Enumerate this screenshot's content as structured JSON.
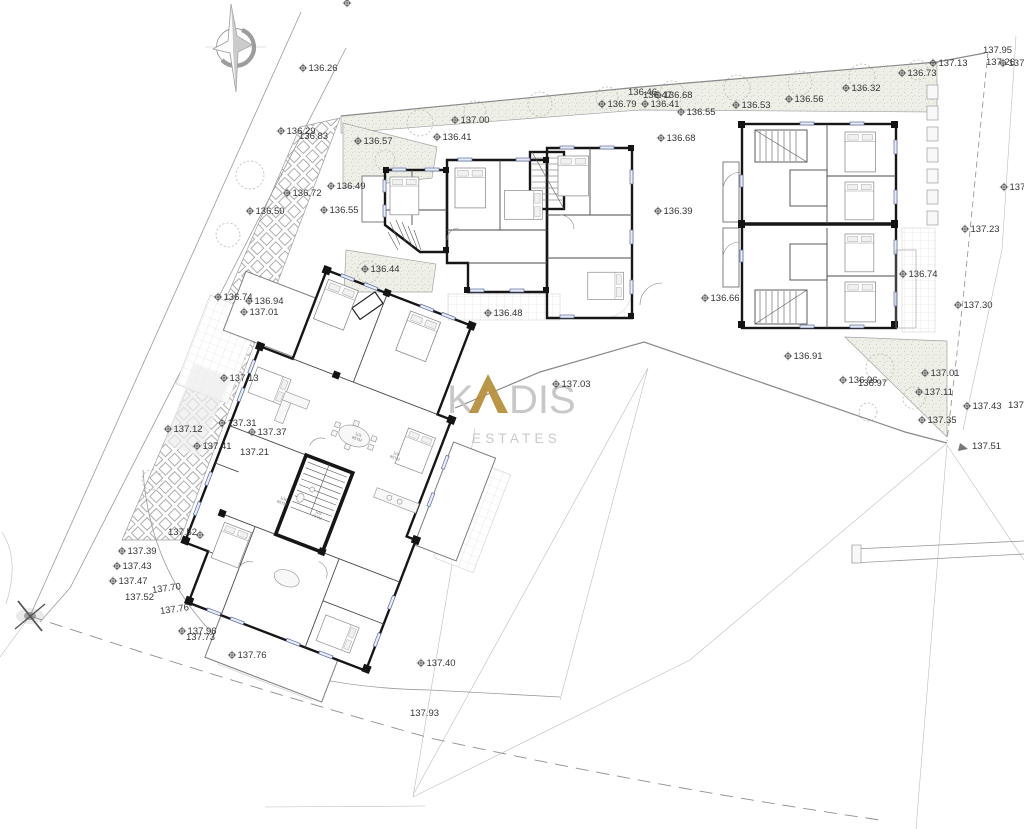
{
  "watermark": {
    "k": "K",
    "dis": "DIS",
    "estates": "ESTATES",
    "gold": "#b58d36",
    "gray": "#c6c6c6"
  },
  "elevation_markers": [
    {
      "x": 303,
      "y": 68,
      "t": "136.26"
    },
    {
      "x": 347,
      "y": 3,
      "t": ""
    },
    {
      "x": 281,
      "y": 131,
      "t": "136.29"
    },
    {
      "x": 299,
      "y": 136,
      "t": "136.83",
      "s": false
    },
    {
      "x": 287,
      "y": 193,
      "t": "136.72"
    },
    {
      "x": 250,
      "y": 211,
      "t": "136.50"
    },
    {
      "x": 358,
      "y": 141,
      "t": "136.57"
    },
    {
      "x": 455,
      "y": 120,
      "t": "137.00"
    },
    {
      "x": 437,
      "y": 137,
      "t": "136.41"
    },
    {
      "x": 331,
      "y": 186,
      "t": "136.49"
    },
    {
      "x": 324,
      "y": 210,
      "t": "136.55"
    },
    {
      "x": 365,
      "y": 269,
      "t": "136.44"
    },
    {
      "x": 602,
      "y": 104,
      "t": "136.79"
    },
    {
      "x": 628,
      "y": 92,
      "t": "136.46",
      "s": false
    },
    {
      "x": 643,
      "y": 95,
      "t": "136.47",
      "s": false
    },
    {
      "x": 658,
      "y": 95,
      "t": "136.68"
    },
    {
      "x": 645,
      "y": 104,
      "t": "136.41"
    },
    {
      "x": 681,
      "y": 112,
      "t": "136.55"
    },
    {
      "x": 661,
      "y": 138,
      "t": "136.68"
    },
    {
      "x": 658,
      "y": 211,
      "t": "136.39"
    },
    {
      "x": 736,
      "y": 105,
      "t": "136.53"
    },
    {
      "x": 789,
      "y": 99,
      "t": "136.56"
    },
    {
      "x": 846,
      "y": 88,
      "t": "136.32"
    },
    {
      "x": 902,
      "y": 73,
      "t": "136.73"
    },
    {
      "x": 933,
      "y": 63,
      "t": "137.13"
    },
    {
      "x": 983,
      "y": 50,
      "t": "137.95",
      "s": false
    },
    {
      "x": 986,
      "y": 62,
      "t": "137.26",
      "s": false
    },
    {
      "x": 1003,
      "y": 63,
      "t": "137"
    },
    {
      "x": 1004,
      "y": 187,
      "t": "137"
    },
    {
      "x": 965,
      "y": 229,
      "t": "137.23"
    },
    {
      "x": 958,
      "y": 305,
      "t": "137.30"
    },
    {
      "x": 903,
      "y": 274,
      "t": "136.74"
    },
    {
      "x": 705,
      "y": 298,
      "t": "136.66"
    },
    {
      "x": 488,
      "y": 313,
      "t": "136.48"
    },
    {
      "x": 218,
      "y": 297,
      "t": "136.74"
    },
    {
      "x": 249,
      "y": 301,
      "t": "136.94"
    },
    {
      "x": 244,
      "y": 312,
      "t": "137.01"
    },
    {
      "x": 224,
      "y": 378,
      "t": "137.13"
    },
    {
      "x": 222,
      "y": 423,
      "t": "137.31"
    },
    {
      "x": 252,
      "y": 432,
      "t": "137.37"
    },
    {
      "x": 168,
      "y": 429,
      "t": "137.12"
    },
    {
      "x": 197,
      "y": 446,
      "t": "137.41"
    },
    {
      "x": 240,
      "y": 452,
      "t": "137.21",
      "s": false
    },
    {
      "x": 556,
      "y": 384,
      "t": "137.03"
    },
    {
      "x": 788,
      "y": 356,
      "t": "136.91"
    },
    {
      "x": 843,
      "y": 380,
      "t": "136.96"
    },
    {
      "x": 858,
      "y": 383,
      "t": "136.97",
      "s": false
    },
    {
      "x": 925,
      "y": 373,
      "t": "137.01"
    },
    {
      "x": 919,
      "y": 392,
      "t": "137.11"
    },
    {
      "x": 922,
      "y": 420,
      "t": "137.35"
    },
    {
      "x": 967,
      "y": 406,
      "t": "137.43"
    },
    {
      "x": 1008,
      "y": 405,
      "t": "137.52",
      "s": false
    },
    {
      "x": 972,
      "y": 446,
      "t": "137.51",
      "s": false
    },
    {
      "x": 200,
      "y": 535,
      "t": ""
    },
    {
      "x": 168,
      "y": 532,
      "t": "137.52",
      "s": false
    },
    {
      "x": 122,
      "y": 551,
      "t": "137.39"
    },
    {
      "x": 117,
      "y": 566,
      "t": "137.43"
    },
    {
      "x": 113,
      "y": 581,
      "t": "137.47"
    },
    {
      "x": 125,
      "y": 597,
      "t": "137.52",
      "s": false
    },
    {
      "x": 152,
      "y": 590,
      "t": "137.70",
      "s": false,
      "r": -8
    },
    {
      "x": 160,
      "y": 611,
      "t": "137.76",
      "s": false,
      "r": -8
    },
    {
      "x": 182,
      "y": 631,
      "t": "137.96"
    },
    {
      "x": 186,
      "y": 637,
      "t": "137.73",
      "s": false
    },
    {
      "x": 232,
      "y": 655,
      "t": "137.76"
    },
    {
      "x": 421,
      "y": 663,
      "t": "137.40"
    },
    {
      "x": 410,
      "y": 713,
      "t": "137.93",
      "s": false
    }
  ],
  "room_labels": [
    {
      "x": 358,
      "y": 436,
      "no": "101",
      "area": "85TM"
    },
    {
      "x": 396,
      "y": 455,
      "no": "102",
      "area": "85TM"
    },
    {
      "x": 283,
      "y": 500,
      "no": "104",
      "area": "85TM"
    },
    {
      "x": 318,
      "y": 514,
      "no": "103",
      "area": "75TM"
    }
  ],
  "colors": {
    "wall": "#161616",
    "boundary": "#9a9a9a",
    "hatch": "#eef0e8",
    "marker_text": "#353535",
    "window": "#5b6a9e"
  }
}
